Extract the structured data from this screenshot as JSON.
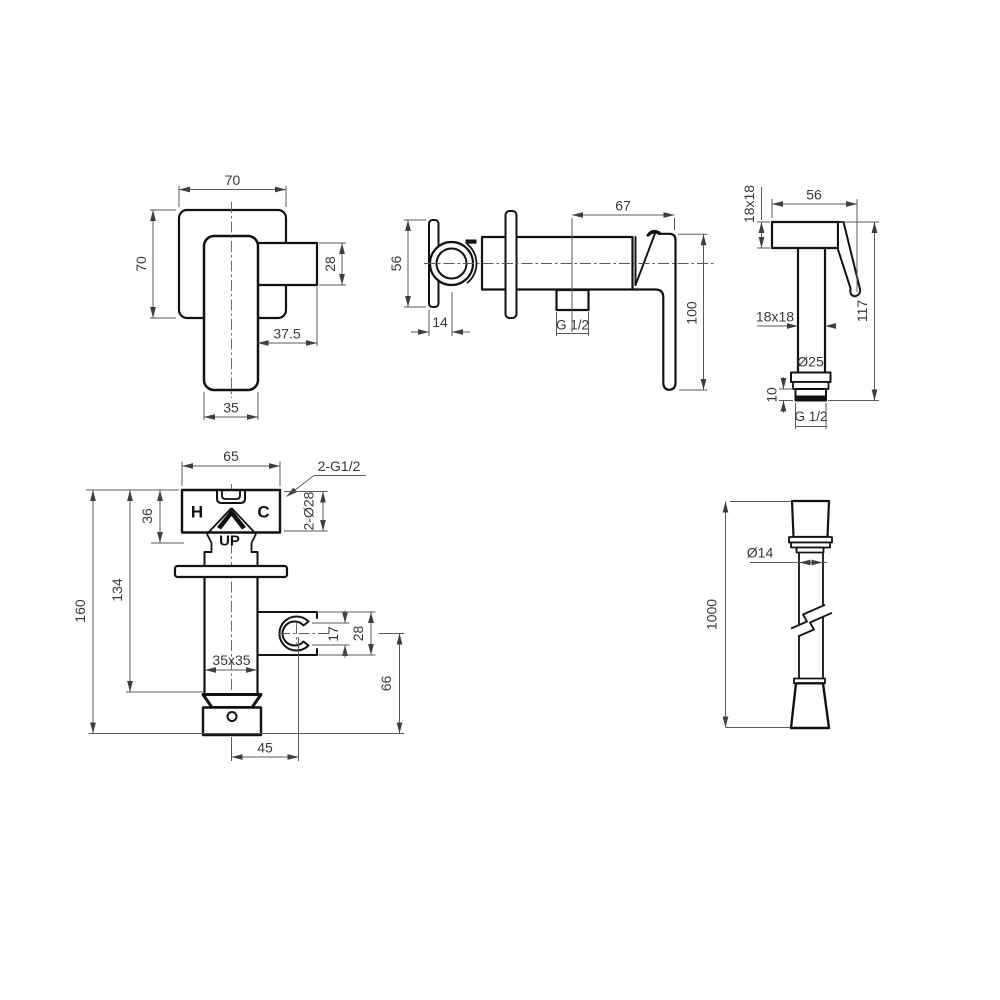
{
  "drawing": {
    "title": "faucet-technical-drawing",
    "background": "#ffffff",
    "colors": {
      "object_line": "#121212",
      "dimension_line": "#5a5a5a",
      "dimension_text": "#383838",
      "label_text": "#111111"
    },
    "views": {
      "handle_front": {
        "dims": {
          "top_width": "70",
          "side_height": "70",
          "spout_height": "28",
          "spout_length": "37.5",
          "handle_width": "35"
        }
      },
      "mixer_side": {
        "dims": {
          "knob_plate_height": "56",
          "knob_offset": "14",
          "outlet_thread": "G 1/2",
          "center_to_handle": "67",
          "handle_length": "100"
        }
      },
      "sprayer": {
        "dims": {
          "head_section": "18x18",
          "head_width": "56",
          "total_height": "117",
          "body_section": "18x18",
          "nut_diameter": "Ø25",
          "thread_length": "10",
          "inlet_thread": "G 1/2"
        }
      },
      "mixer_front": {
        "labels": {
          "hot": "H",
          "cold": "C",
          "orientation": "UP"
        },
        "dims": {
          "body_width": "65",
          "inlet_threads": "2-G1/2",
          "inlet_bores": "2-Ø28",
          "valve_height": "36",
          "wall_to_cap": "134",
          "total_height": "160",
          "tube_section": "35x35",
          "clip_opening": "17",
          "holder_height": "28",
          "holder_drop": "66",
          "holder_offset": "45"
        }
      },
      "hose": {
        "dims": {
          "hose_diameter": "Ø14",
          "hose_length": "1000"
        }
      }
    }
  }
}
